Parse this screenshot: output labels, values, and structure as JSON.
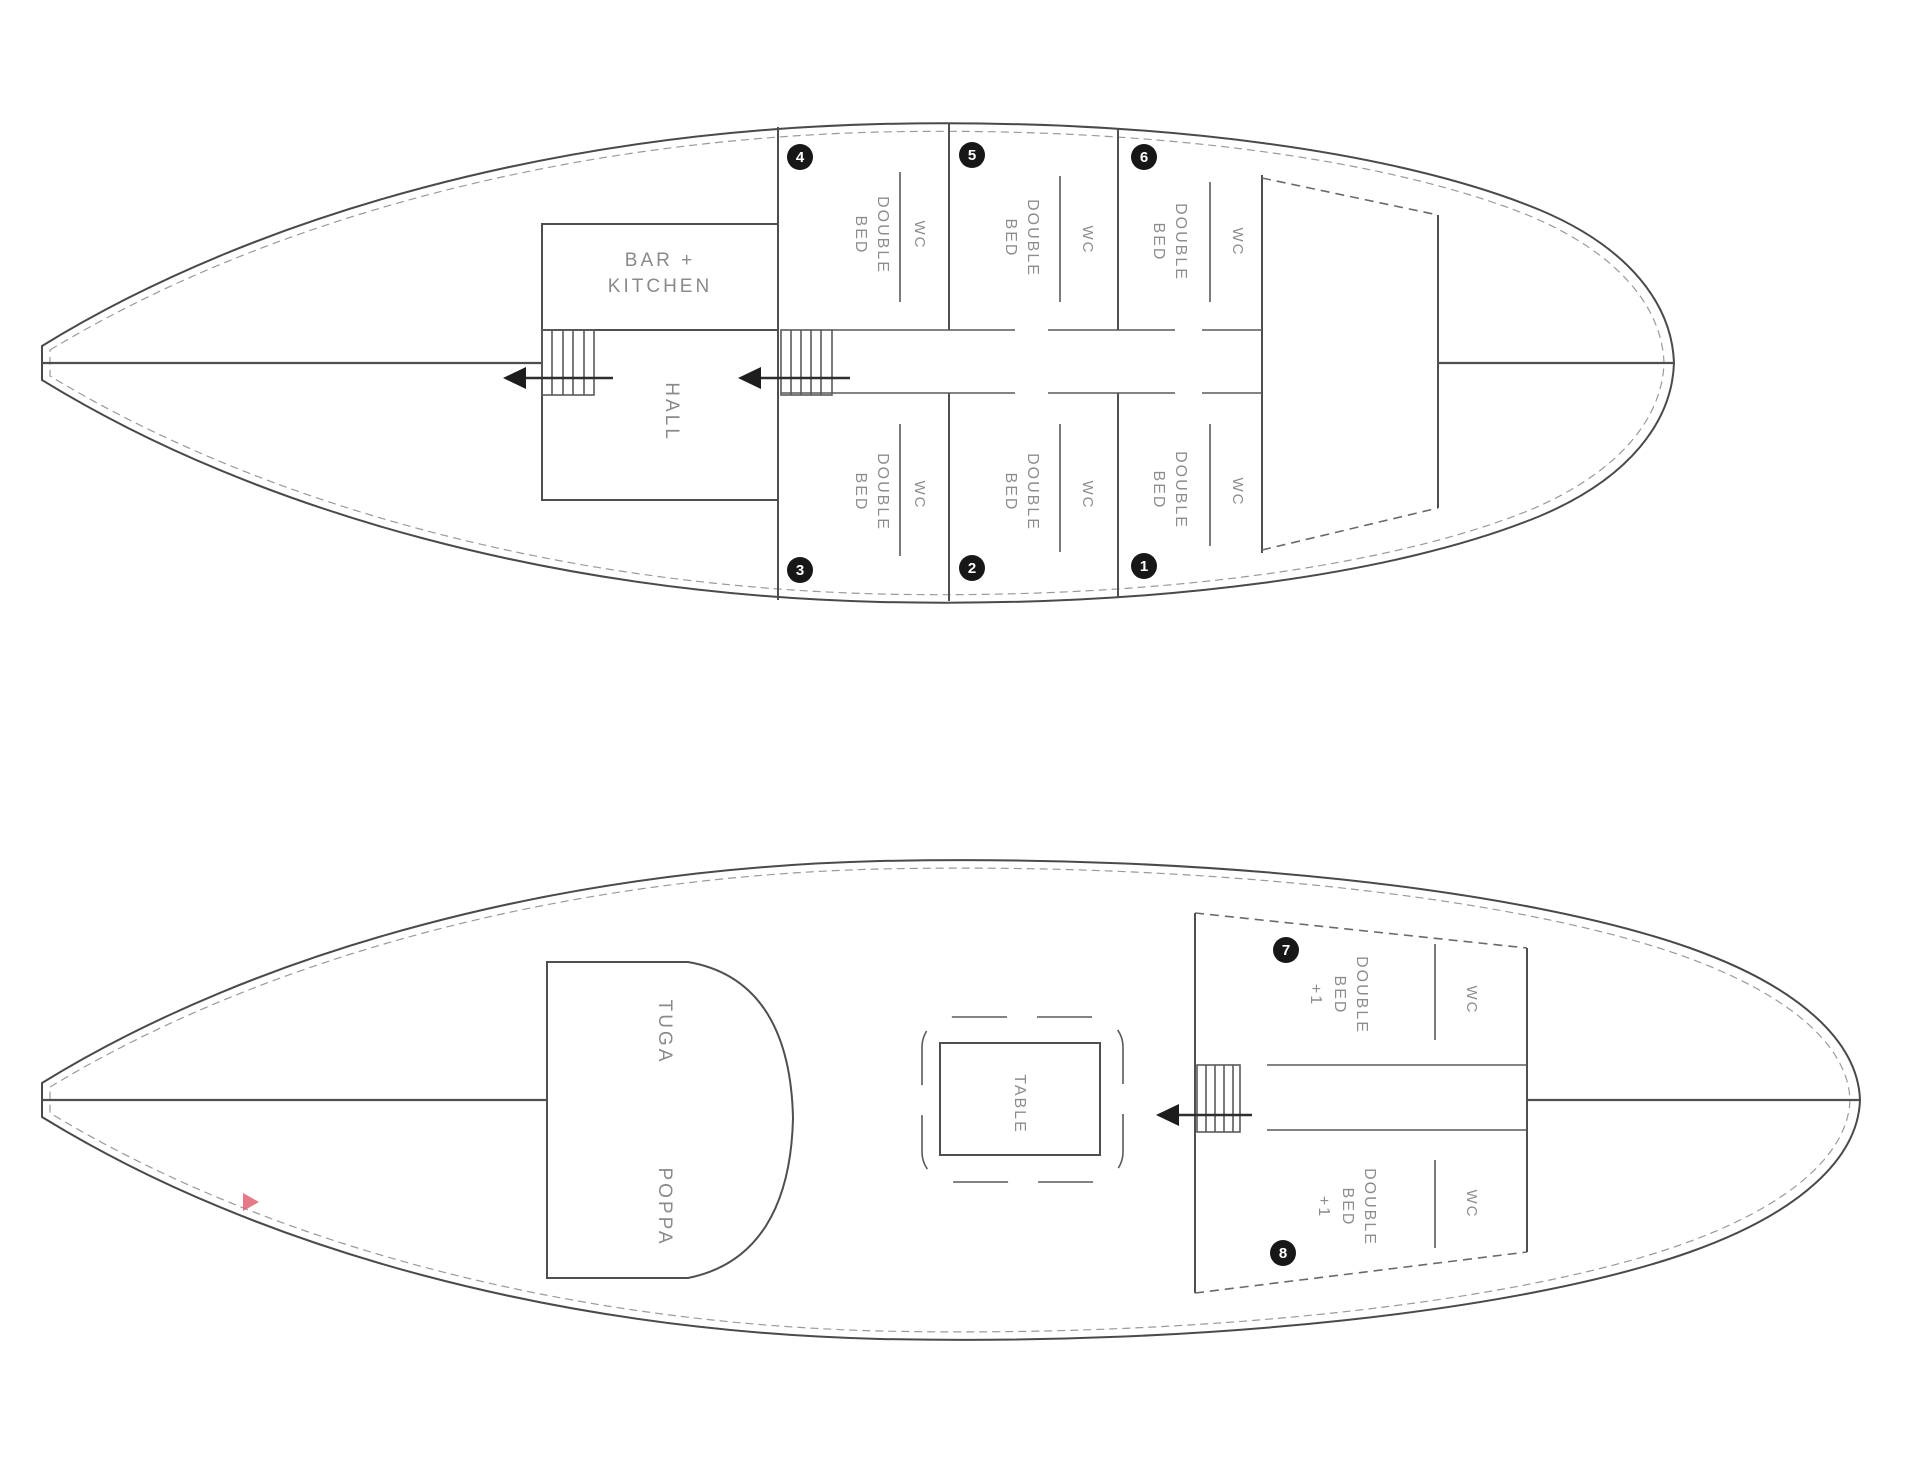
{
  "doc": {
    "type": "yacht deck floor plan",
    "line_color": "#4a4a4a",
    "text_color": "#8c8c8c",
    "accent_marker_color": "#e06273"
  },
  "upper_deck": {
    "bar_kitchen_line1": "BAR +",
    "bar_kitchen_line2": "KITCHEN",
    "hall": "HALL",
    "cabins": [
      {
        "num": "4",
        "l1": "DOUBLE",
        "l2": "BED",
        "wc": "WC"
      },
      {
        "num": "5",
        "l1": "DOUBLE",
        "l2": "BED",
        "wc": "WC"
      },
      {
        "num": "6",
        "l1": "DOUBLE",
        "l2": "BED",
        "wc": "WC"
      },
      {
        "num": "3",
        "l1": "DOUBLE",
        "l2": "BED",
        "wc": "WC"
      },
      {
        "num": "2",
        "l1": "DOUBLE",
        "l2": "BED",
        "wc": "WC"
      },
      {
        "num": "1",
        "l1": "DOUBLE",
        "l2": "BED",
        "wc": "WC"
      }
    ]
  },
  "main_deck": {
    "tuga": "TUGA",
    "poppa": "POPPA",
    "table": "TABLE",
    "cabins": [
      {
        "num": "7",
        "l1": "DOUBLE",
        "l2": "BED",
        "l3": "+1",
        "wc": "WC"
      },
      {
        "num": "8",
        "l1": "DOUBLE",
        "l2": "BED",
        "l3": "+1",
        "wc": "WC"
      }
    ]
  }
}
